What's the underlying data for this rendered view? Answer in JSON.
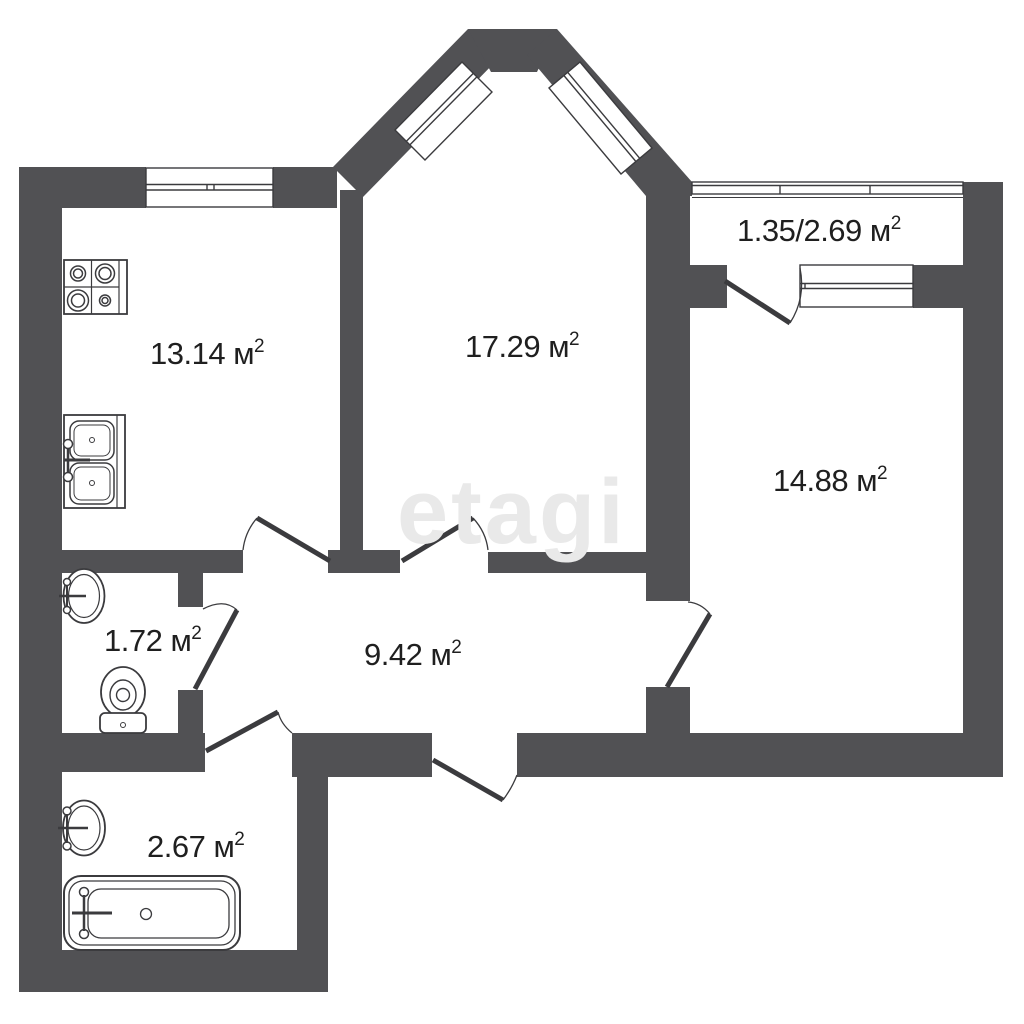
{
  "plan": {
    "title": "apartment-floor-plan",
    "watermark": "etagi",
    "colors": {
      "wall": "#515154",
      "line": "#3b3b3e",
      "text": "#1f1f1f",
      "watermark": "#e9e9e9",
      "background": "#ffffff"
    },
    "rooms": [
      {
        "id": "kitchen",
        "area": "13.14 м",
        "sup": "2"
      },
      {
        "id": "living-room",
        "area": "17.29 м",
        "sup": "2"
      },
      {
        "id": "balcony",
        "area": "1.35/2.69 м",
        "sup": "2"
      },
      {
        "id": "bedroom",
        "area": "14.88 м",
        "sup": "2"
      },
      {
        "id": "wc",
        "area": "1.72 м",
        "sup": "2"
      },
      {
        "id": "hallway",
        "area": "9.42 м",
        "sup": "2"
      },
      {
        "id": "bathroom",
        "area": "2.67 м",
        "sup": "2"
      }
    ],
    "fixtures": [
      "stove-icon",
      "kitchen-sink-icon",
      "wc-basin-icon",
      "toilet-icon",
      "bath-basin-icon",
      "bathtub-icon"
    ],
    "doors": [
      "kitchen-door",
      "living-room-door",
      "wc-door",
      "bathroom-door",
      "entrance-door",
      "bedroom-door",
      "balcony-door"
    ],
    "windows": [
      "kitchen-window",
      "bay-window-left",
      "bay-window-right",
      "balcony-glazing",
      "balcony-partition-window"
    ]
  }
}
